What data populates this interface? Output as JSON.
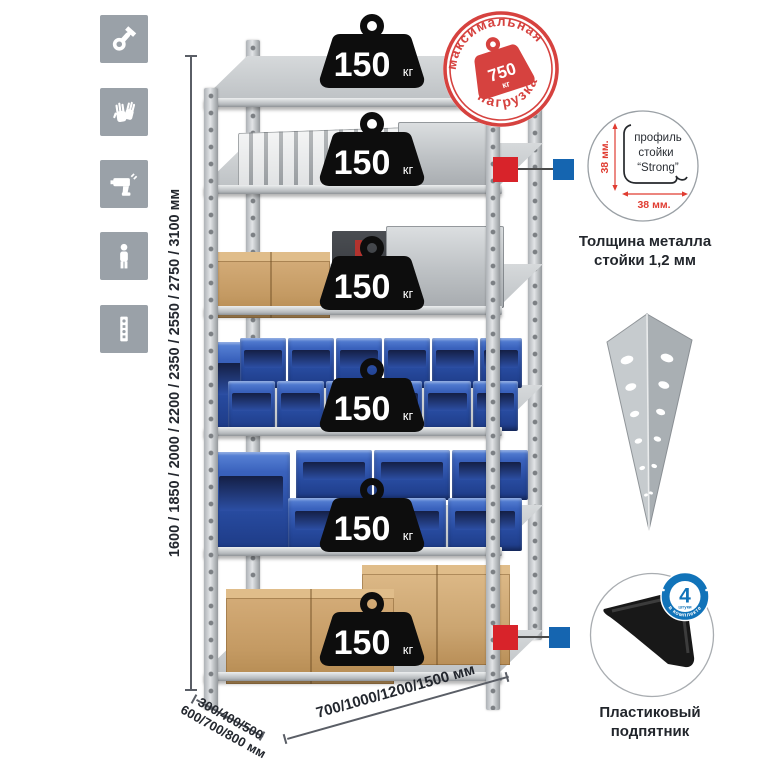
{
  "left_toolbar": {
    "bg_color": "#9aa1a8",
    "icons": [
      {
        "name": "wrench-icon"
      },
      {
        "name": "gloves-icon"
      },
      {
        "name": "drill-icon"
      },
      {
        "name": "person-icon"
      },
      {
        "name": "rack-post-icon"
      }
    ]
  },
  "height_dimension": {
    "label": "1600 / 1850 / 2000 / 2200 / 2350 / 2550 / 2750 / 3100 мм"
  },
  "depth_dimension": {
    "line1": "300/400/500",
    "line2": "600/700/800 мм"
  },
  "width_dimension": {
    "label": "700/1000/1200/1500 мм"
  },
  "shelf_load": {
    "value": "150",
    "unit": "кг"
  },
  "max_load_stamp": {
    "arc_top": "максимальная",
    "arc_bottom": "нагрузка",
    "value": "750",
    "unit": "кг",
    "color": "#d6423f"
  },
  "post_profile_detail": {
    "line1": "профиль",
    "line2": "стойки",
    "line3": "“Strong”",
    "dim_vertical": "38 мм.",
    "dim_horizontal": "38 мм.",
    "caption_line1": "Толщина металла",
    "caption_line2": "стойки 1,2 мм"
  },
  "plastic_foot_detail": {
    "badge_count": "4",
    "badge_sub": "штуки",
    "badge_arc": "в комплекте",
    "caption_line1": "Пластиковый",
    "caption_line2": "подпятник"
  },
  "colors": {
    "stamp_red": "#d6423f",
    "dim_red": "#e03c31",
    "badge_blue": "#1173b9",
    "marker_red": "#d8232a",
    "marker_blue": "#1565b0",
    "bin_blue": "#2f5bb5",
    "cardboard": "#c89f6e",
    "metal_light": "#d6d9db",
    "metal_dark": "#9aa0a5",
    "text_dark": "#22262c"
  }
}
